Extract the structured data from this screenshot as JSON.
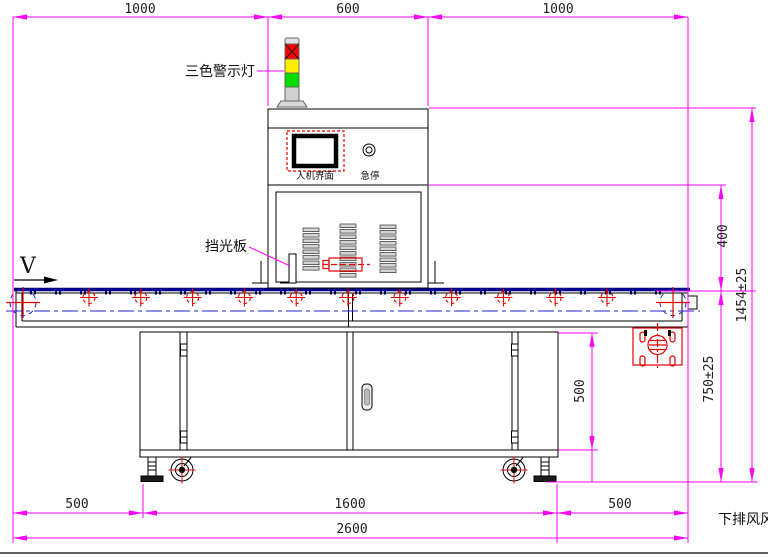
{
  "labels": {
    "warning_light": "三色警示灯",
    "light_shield": "挡光板",
    "hmi_panel": "人机界面",
    "emergency_stop": "急停",
    "belt_direction": "V",
    "exhaust_note": "下排风风"
  },
  "dimensions": {
    "top_left": "1000",
    "top_center": "600",
    "top_right": "1000",
    "head_to_belt": "400",
    "total_height": "1454±25",
    "belt_height": "750±25",
    "cabinet_height": "500",
    "bottom_left": "500",
    "bottom_center": "1600",
    "bottom_right": "500",
    "total_length": "2600"
  },
  "colors": {
    "dimension_line": "#ff00ff",
    "belt": "#00008b",
    "centerline": "#2222cc",
    "detail_red": "#e60000",
    "lamp_red": "#fc0000",
    "lamp_yellow": "#ffee00",
    "lamp_green": "#00dd00",
    "lamp_gray": "#d0d0d0"
  }
}
